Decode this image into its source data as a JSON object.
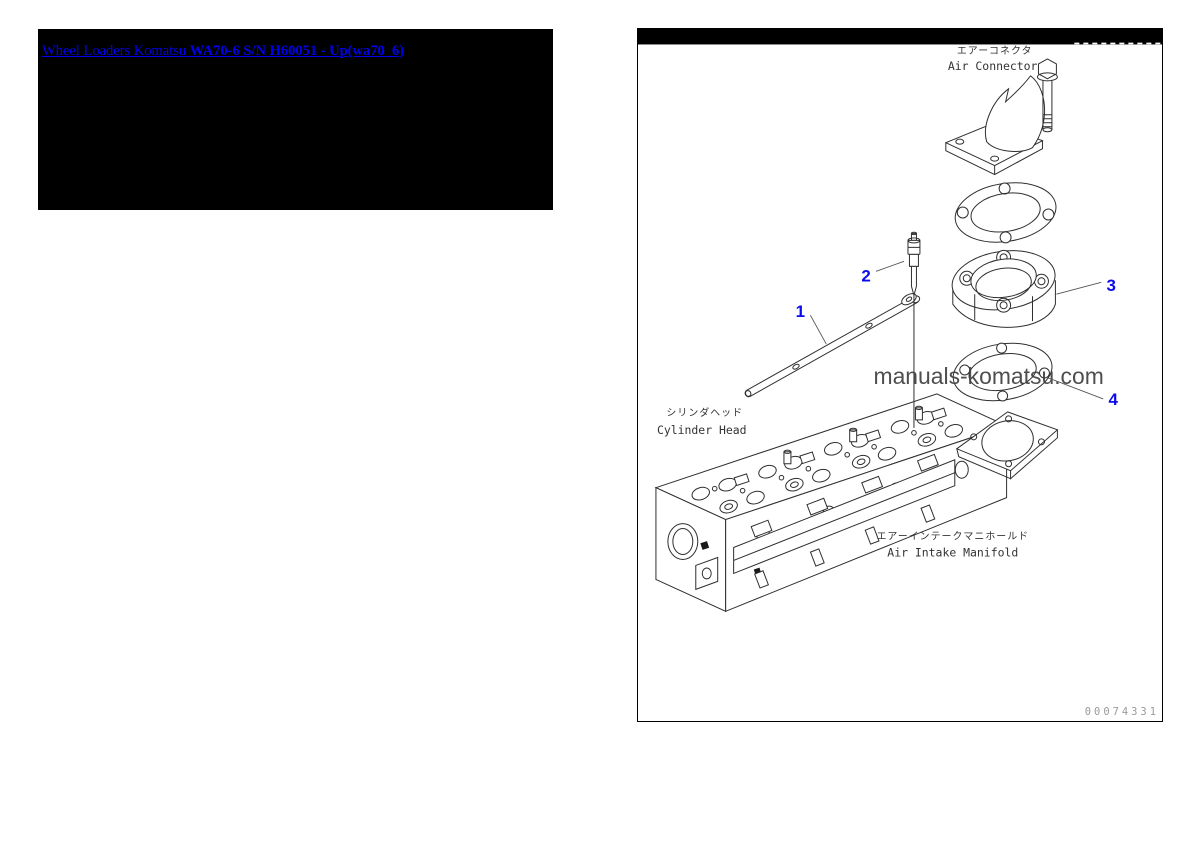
{
  "header": {
    "link_part1": "Wheel Loaders Komatsu",
    "link_part2": "WA70-6 S/N H60051 - Up(wa70_6)",
    "link_color": "#0000ee",
    "banner_bg": "#000000"
  },
  "diagram": {
    "frame_color": "#000000",
    "topbar_bg": "#000000",
    "line_color": "#2f2f2f",
    "callout_color": "#0b0bee",
    "labels": {
      "air_connector": {
        "jp": "エアーコネクタ",
        "en": "Air Connector"
      },
      "cylinder_head": {
        "jp": "シリンダヘッド",
        "en": "Cylinder Head"
      },
      "air_intake_manifold": {
        "jp": "エアーインテークマニホールド",
        "en": "Air Intake Manifold"
      }
    },
    "callouts": [
      {
        "number": "1"
      },
      {
        "number": "2"
      },
      {
        "number": "3"
      },
      {
        "number": "4"
      }
    ],
    "watermark": "manuals-komatsu.com",
    "drawing_code": "00074331"
  }
}
